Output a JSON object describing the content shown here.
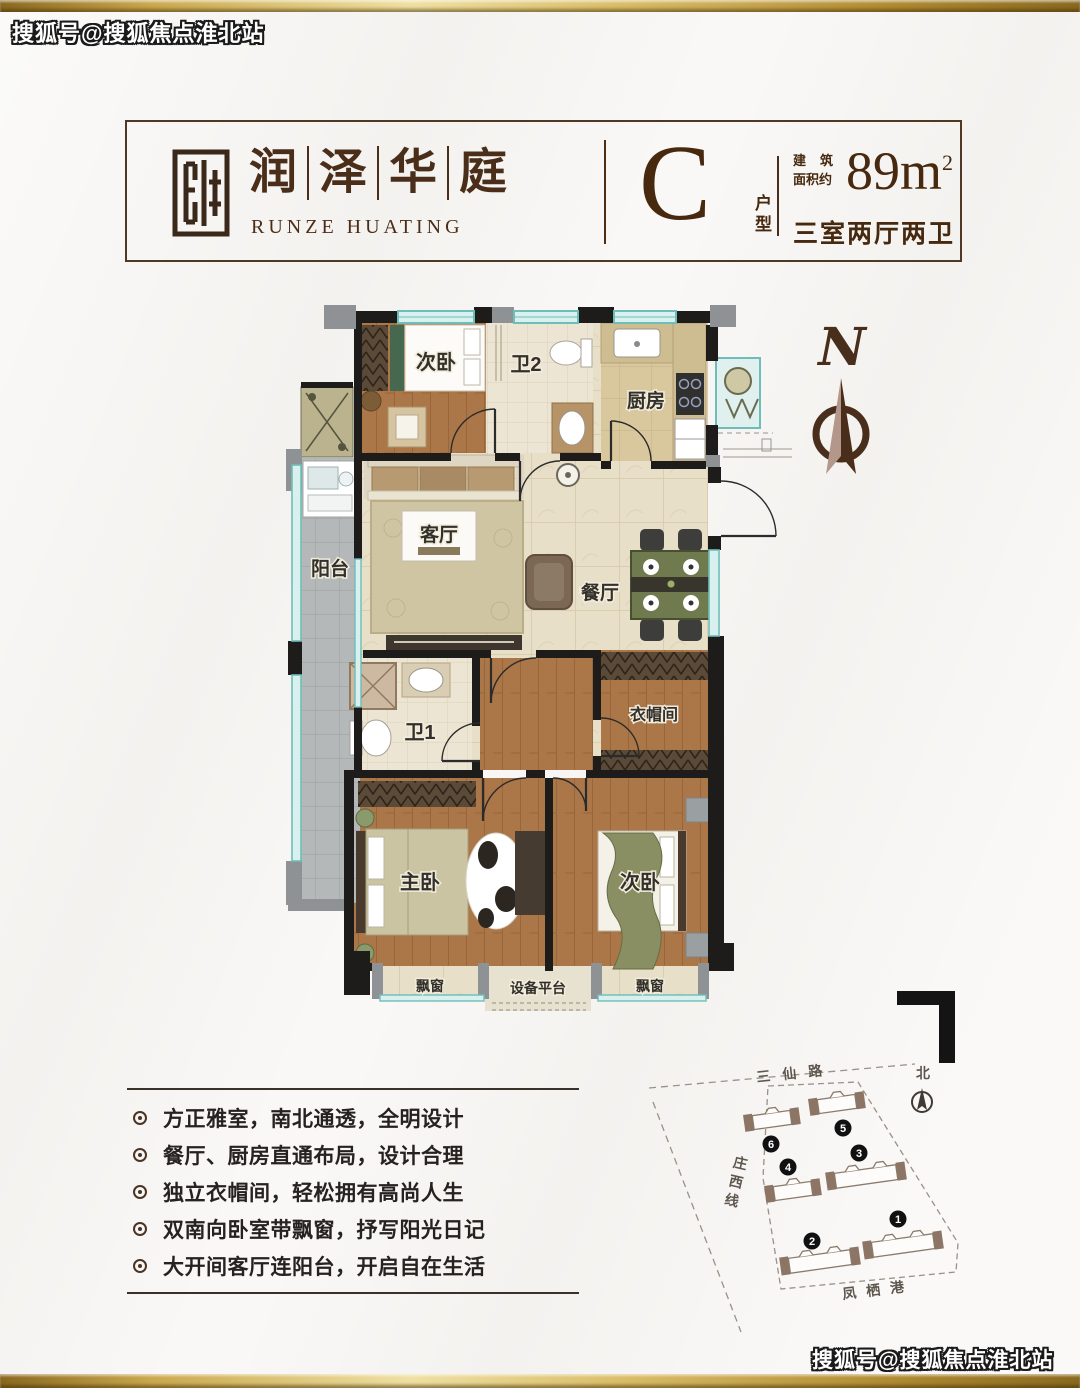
{
  "watermark": {
    "top": "搜狐号@搜狐焦点淮北站",
    "bottom": "搜狐号@搜狐焦点淮北站"
  },
  "header": {
    "brand": {
      "chars": [
        "润",
        "泽",
        "华",
        "庭"
      ],
      "en": "RUNZE HUATING"
    },
    "unit": {
      "letter": "C",
      "label": "户型"
    },
    "area": {
      "prefix_line1": "建筑",
      "prefix_line2": "面积约",
      "value": "89m",
      "sup": "2"
    },
    "layout": "三室两厅两卫"
  },
  "floorplan": {
    "compass_letter": "N",
    "rooms": {
      "bedroom_top": "次卧",
      "bath2": "卫2",
      "kitchen": "厨房",
      "balcony": "阳台",
      "living": "客厅",
      "dining": "餐厅",
      "bath1": "卫1",
      "cloak": "衣帽间",
      "master": "主卧",
      "bedroom_bottom": "次卧",
      "bay_left": "飘窗",
      "equipment": "设备平台",
      "bay_right": "飘窗"
    }
  },
  "features": {
    "items": [
      "方正雅室，南北通透，全明设计",
      "餐厅、厨房直通布局，设计合理",
      "独立衣帽间，轻松拥有高尚人生",
      "双南向卧室带飘窗，抒写阳光日记",
      "大开间客厅连阳台，开启自在生活"
    ]
  },
  "sitemap": {
    "roads": {
      "top": "三仙路",
      "left": "庄西线",
      "bottom": "凤栖港"
    },
    "north_label": "北",
    "buildings": [
      "1",
      "2",
      "3",
      "4",
      "5",
      "6"
    ]
  },
  "colors": {
    "gold": "#c9a84c",
    "brown": "#47290f",
    "teal": "#7ac7c4",
    "wood": "#ab7648"
  }
}
